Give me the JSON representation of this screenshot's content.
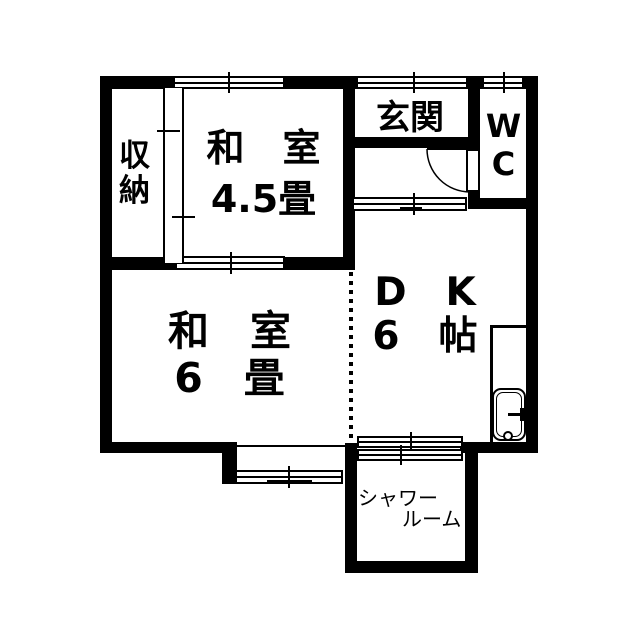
{
  "plan": {
    "type": "floorplan",
    "colors": {
      "wall": "#000000",
      "background": "#ffffff",
      "text": "#000000"
    },
    "rooms": {
      "closet": {
        "label": "収\n納"
      },
      "washitsu_4_5": {
        "name": "和　室",
        "size": "4.5畳"
      },
      "genkan": {
        "label": "玄関"
      },
      "wc": {
        "label": "W\nC"
      },
      "washitsu_6": {
        "name": "和　室",
        "size": "6　畳"
      },
      "dining_kitchen": {
        "name": "D　K",
        "size": "6　帖"
      },
      "shower_room": {
        "label_line1": "シャワー",
        "label_line2": "ルーム"
      }
    }
  }
}
